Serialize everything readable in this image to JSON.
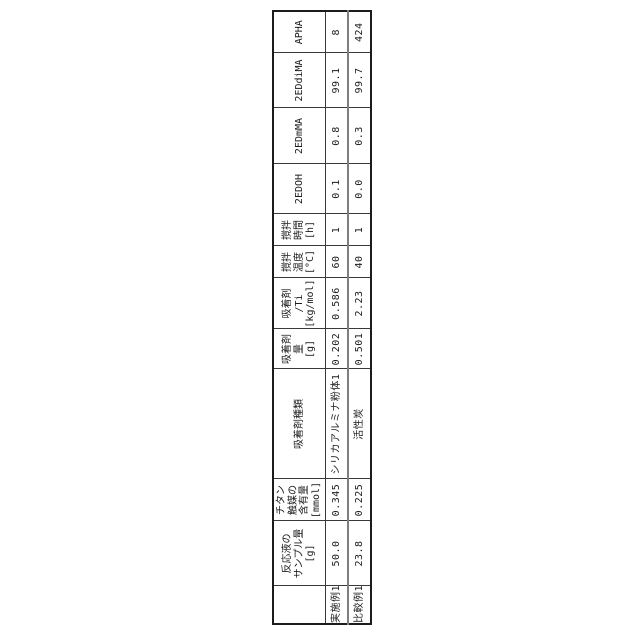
{
  "figure": {
    "description_colors": {
      "background": "#ffffff",
      "grid_line": "#3a3a3a",
      "outer_border": "#1c1c1c",
      "row_separator": "#7e7e7e",
      "text": "#1c1c1c"
    }
  },
  "table": {
    "header": {
      "corner": "",
      "cols": [
        {
          "lines": [
            "反応液の",
            "サンプル量",
            "[g]"
          ]
        },
        {
          "lines": [
            "チタン",
            "触媒の",
            "含有量",
            "[mmol]"
          ]
        },
        {
          "lines": [
            "吸着剤種類"
          ]
        },
        {
          "lines": [
            "吸着剤",
            "量",
            "[g]"
          ]
        },
        {
          "lines": [
            "吸着剤",
            "/Ti",
            "[kg/mol]"
          ]
        },
        {
          "lines": [
            "撹拌",
            "温度",
            "[°C]"
          ]
        },
        {
          "lines": [
            "撹拌",
            "時間",
            "[h]"
          ]
        },
        {
          "lines": [
            "2EDOH"
          ]
        },
        {
          "lines": [
            "2EDmMA"
          ]
        },
        {
          "lines": [
            "2EDdiMA"
          ]
        },
        {
          "lines": [
            "APHA"
          ]
        }
      ]
    },
    "rows": [
      {
        "label": "実施例1",
        "values": [
          "50.0",
          "0.345",
          "シリカアルミナ粉体1",
          "0.202",
          "0.586",
          "60",
          "1",
          "0.1",
          "0.8",
          "99.1",
          "8"
        ]
      },
      {
        "label": "比較例1",
        "values": [
          "23.8",
          "0.225",
          "活性炭",
          "0.501",
          "2.23",
          "40",
          "1",
          "0.0",
          "0.3",
          "99.7",
          "424"
        ]
      }
    ]
  },
  "chart_data": {
    "type": "table",
    "orientation": "rotated-90-ccw",
    "columns": [
      "反応液のサンプル量 [g]",
      "チタン触媒の含有量 [mmol]",
      "吸着剤種類",
      "吸着剤量 [g]",
      "吸着剤/Ti [kg/mol]",
      "撹拌温度 [°C]",
      "撹拌時間 [h]",
      "2EDOH",
      "2EDmMA",
      "2EDdiMA",
      "APHA"
    ],
    "rows": [
      {
        "label": "実施例1",
        "values": [
          "50.0",
          "0.345",
          "シリカアルミナ粉体1",
          "0.202",
          "0.586",
          "60",
          "1",
          "0.1",
          "0.8",
          "99.1",
          "8"
        ]
      },
      {
        "label": "比較例1",
        "values": [
          "23.8",
          "0.225",
          "活性炭",
          "0.501",
          "2.23",
          "40",
          "1",
          "0.0",
          "0.3",
          "99.7",
          "424"
        ]
      }
    ]
  }
}
